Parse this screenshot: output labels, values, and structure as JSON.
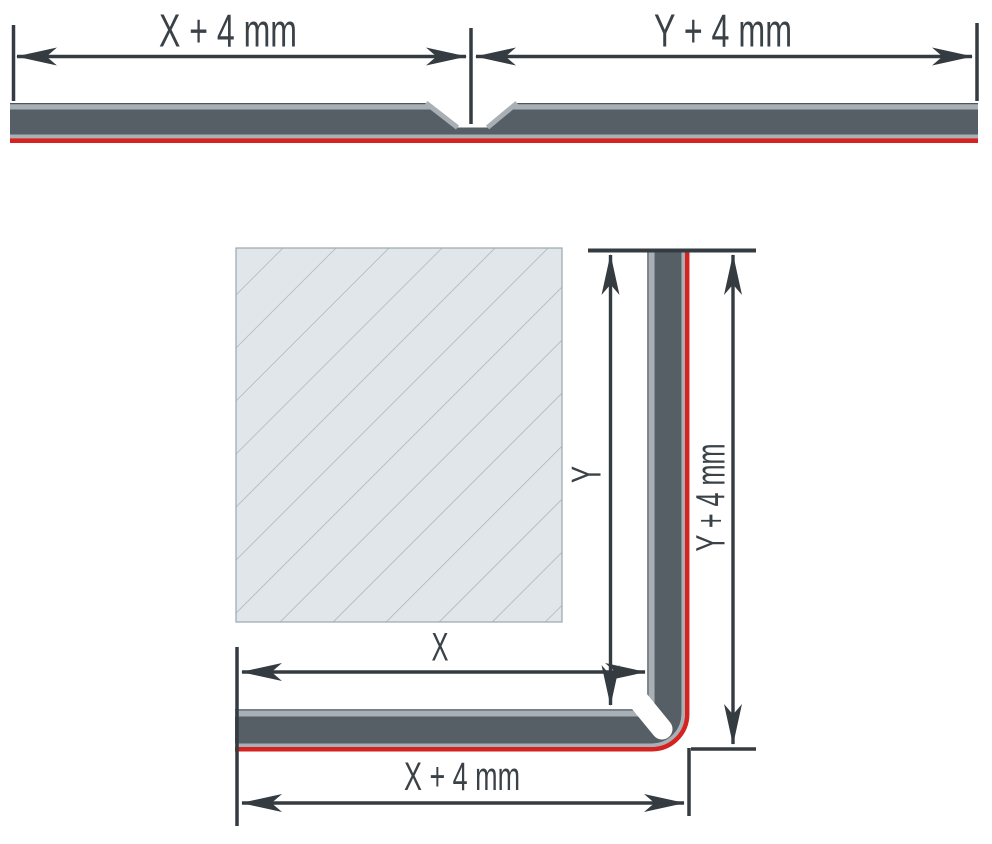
{
  "diagram": {
    "flat_view": {
      "left_dim_label": "X + 4 mm",
      "right_dim_label": "Y + 4 mm"
    },
    "folded_view": {
      "inner_vertical_dim_label": "Y",
      "outer_vertical_dim_label": "Y + 4 mm",
      "inner_horizontal_dim_label": "X",
      "outer_horizontal_dim_label": "X + 4 mm"
    }
  },
  "colors": {
    "line": "#343b41",
    "text": "#3a4147",
    "panel-dark": "#575f66",
    "panel-light": "#a9b0b5",
    "panel-edge": "#4e565c",
    "accent-red": "#d42321",
    "hatch-fill": "#e0e6ea",
    "hatch-line": "#aab5bc",
    "hatch-border": "#9ba7ae",
    "background": "#ffffff"
  }
}
